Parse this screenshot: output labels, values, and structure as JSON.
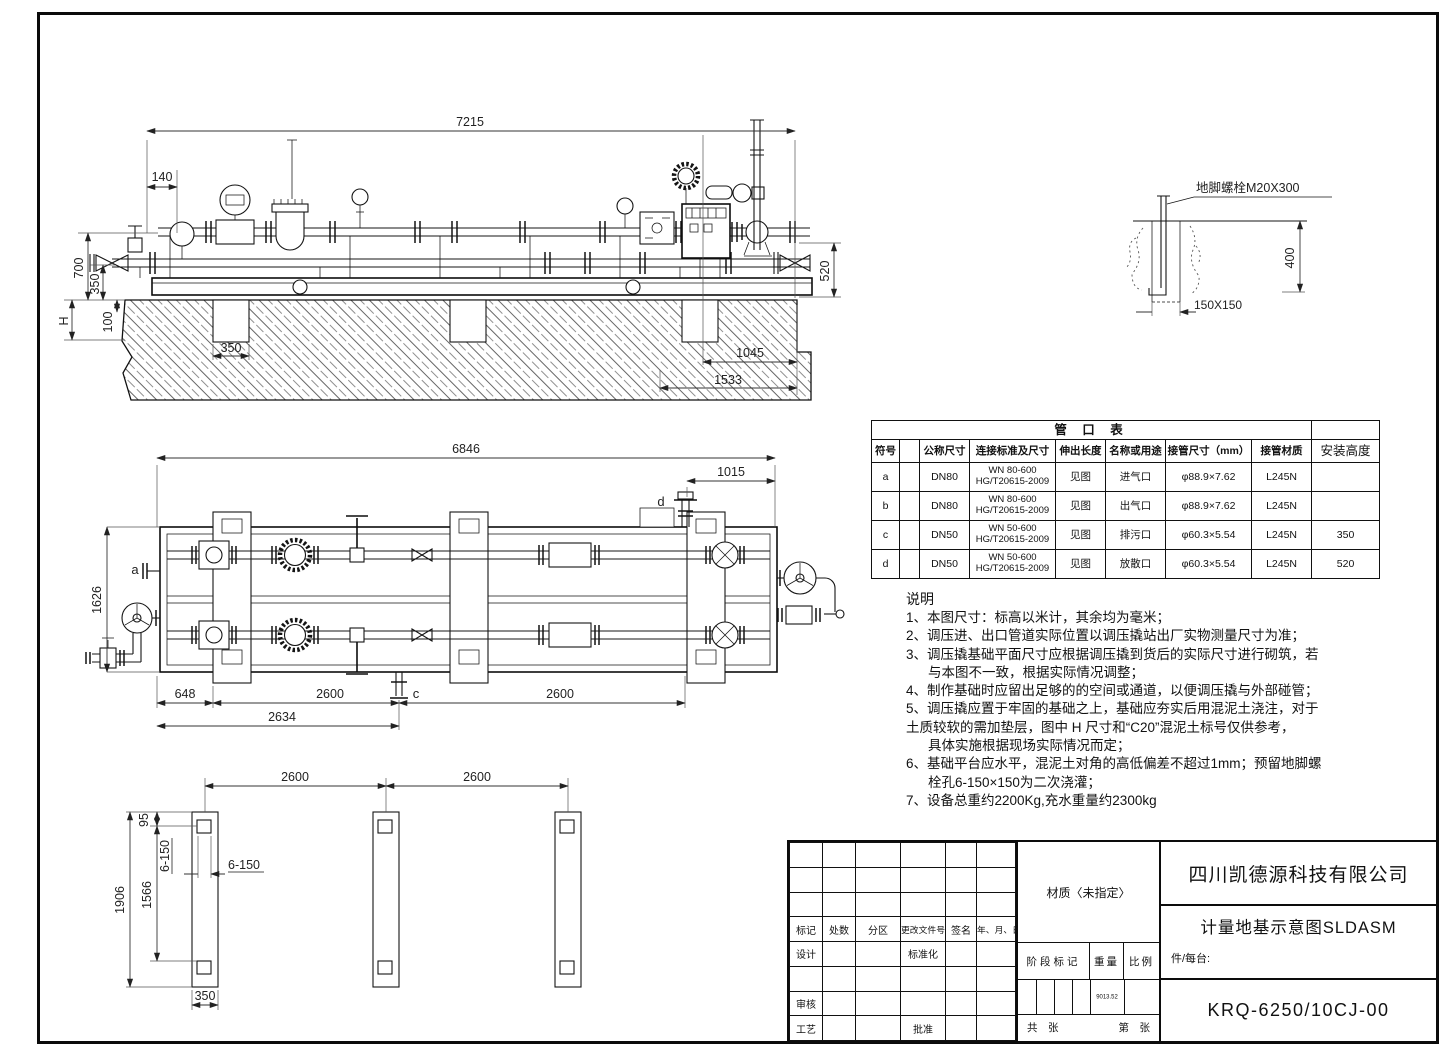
{
  "elevation": {
    "dims": {
      "d7215": "7215",
      "d140": "140",
      "d700": "700",
      "d350v": "350",
      "dH": "H",
      "d100": "100",
      "d350p": "350",
      "d1045": "1045",
      "d1533": "1533",
      "d520": "520"
    }
  },
  "anchor_detail": {
    "label": "地脚螺栓M20X300",
    "d400": "400",
    "d150": "150X150"
  },
  "plan": {
    "dims": {
      "d6846": "6846",
      "d1015": "1015",
      "d1626": "1626",
      "d648": "648",
      "d2600a": "2600",
      "d2600b": "2600",
      "d2634": "2634"
    },
    "nozzles": {
      "a": "a",
      "c": "c",
      "d": "d"
    }
  },
  "foundation": {
    "dims": {
      "d2600a": "2600",
      "d2600b": "2600",
      "d1906": "1906",
      "d1566": "1566",
      "d95": "95",
      "d6150v": "6-150",
      "d6150h": "6-150",
      "d350": "350"
    }
  },
  "nozzle_table": {
    "title": "管 口 表",
    "headers": [
      "符号",
      "",
      "公称尺寸",
      "连接标准及尺寸",
      "伸出长度",
      "名称或用途",
      "接管尺寸（mm）",
      "接管材质",
      "安装高度"
    ],
    "rows": [
      {
        "sym": "a",
        "size": "DN80",
        "std1": "WN 80-600",
        "std2": "HG/T20615-2009",
        "ext": "见图",
        "name": "进气口",
        "pipe": "φ88.9×7.62",
        "mat": "L245N",
        "height": ""
      },
      {
        "sym": "b",
        "size": "DN80",
        "std1": "WN 80-600",
        "std2": "HG/T20615-2009",
        "ext": "见图",
        "name": "出气口",
        "pipe": "φ88.9×7.62",
        "mat": "L245N",
        "height": ""
      },
      {
        "sym": "c",
        "size": "DN50",
        "std1": "WN 50-600",
        "std2": "HG/T20615-2009",
        "ext": "见图",
        "name": "排污口",
        "pipe": "φ60.3×5.54",
        "mat": "L245N",
        "height": "350"
      },
      {
        "sym": "d",
        "size": "DN50",
        "std1": "WN 50-600",
        "std2": "HG/T20615-2009",
        "ext": "见图",
        "name": "放散口",
        "pipe": "φ60.3×5.54",
        "mat": "L245N",
        "height": "520"
      }
    ]
  },
  "notes": {
    "title": "说明",
    "lines": [
      {
        "text": "1、本图尺寸：标高以米计，其余均为毫米；"
      },
      {
        "text": "2、调压进、出口管道实际位置以调压撬站出厂实物测量尺寸为准；"
      },
      {
        "text": "3、调压撬基础平面尺寸应根据调压撬到货后的实际尺寸进行砌筑，若"
      },
      {
        "text": "与本图不一致，根据实际情况调整；"
      },
      {
        "text": "4、制作基础时应留出足够的的空间或通道，以便调压撬与外部碰管；"
      },
      {
        "text": "5、调压撬应置于牢固的基础之上，基础应夯实后用混泥土浇注，对于"
      },
      {
        "text": "土质较软的需加垫层，图中 H 尺寸和“C20”混泥土标号仅供参考，"
      },
      {
        "text": "具体实施根据现场实际情况而定；"
      },
      {
        "text": "6、基础平台应水平，混泥土对角的高低偏差不超过1mm；预留地脚螺"
      },
      {
        "text": "栓孔6-150×150为二次浇灌；"
      },
      {
        "text": "7、设备总重约2200Kg,充水重量约2300kg"
      }
    ]
  },
  "title_block": {
    "company": "四川凯德源科技有限公司",
    "drawing_title": "计量地基示意图SLDASM",
    "per_unit": "件/每台:",
    "drawing_no": "KRQ-6250/10CJ-00",
    "material": "材质〈未指定〉",
    "stage_label": "阶段标记",
    "weight_label": "重量",
    "scale_label": "比例",
    "weight_value": "9013.52",
    "sheets_total": "共　张",
    "sheet_no": "第　张",
    "rev_headers": [
      "标记",
      "处数",
      "分区",
      "更改文件号",
      "签名",
      "年、月、日"
    ],
    "roles": {
      "design": "设计",
      "standardization": "标准化",
      "review": "审核",
      "process": "工艺",
      "approve": "批准"
    }
  }
}
